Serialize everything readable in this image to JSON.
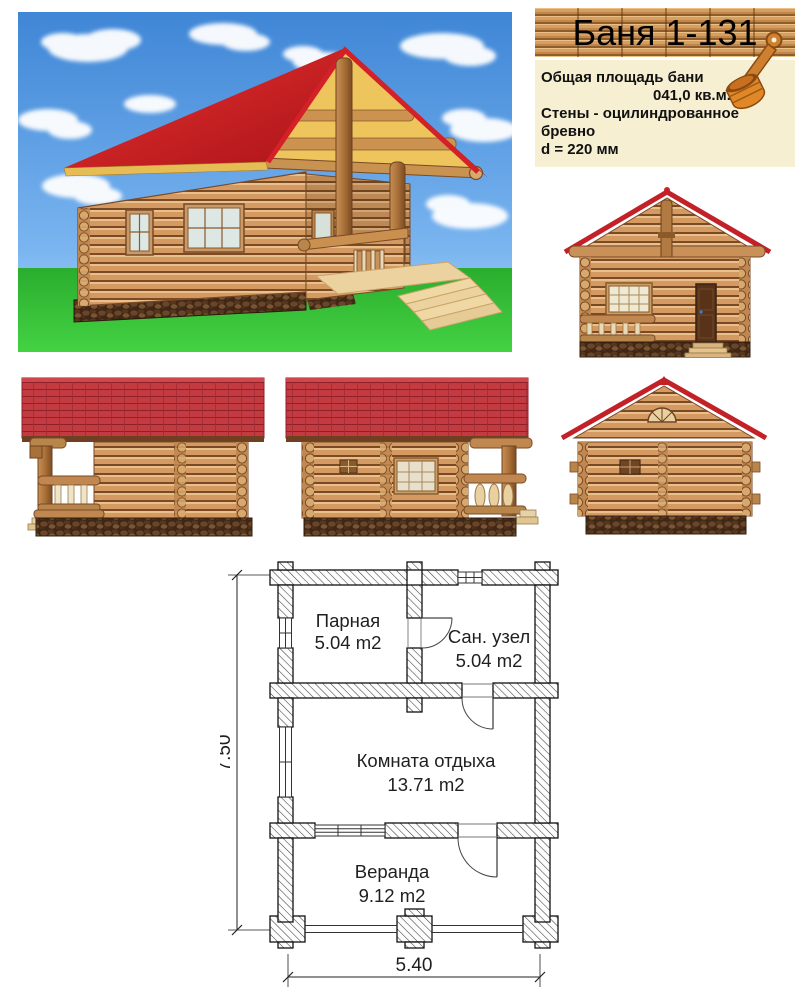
{
  "header": {
    "title": "Баня 1-131",
    "info": {
      "line1": "Общая площадь бани",
      "line2": "041,0 кв.м.",
      "line3": "Стены - оцилиндрованное бревно",
      "line4": "d = 220 мм"
    }
  },
  "floor_plan": {
    "rooms": [
      {
        "name": "Парная",
        "area": "5.04 m2"
      },
      {
        "name": "Сан. узел",
        "area": "5.04 m2"
      },
      {
        "name": "Комната отдыха",
        "area": "13.71 m2"
      },
      {
        "name": "Веранда",
        "area": "9.12 m2"
      }
    ],
    "dimensions": {
      "overall_width_m": "5.40",
      "overall_depth_m": "7.50"
    }
  },
  "colors": {
    "roof_red": "#c5343c",
    "roof_trim_red": "#c22127",
    "log_tan": "#d49a62",
    "log_seam": "#794a23",
    "gable_yellow": "#eec45c",
    "grass_green": "#2db92d",
    "sky_blue": "#4e97e4",
    "info_bg_cream": "#f6efd2",
    "banner_wood": "#d59e62",
    "plan_line": "#1a1a1a"
  }
}
